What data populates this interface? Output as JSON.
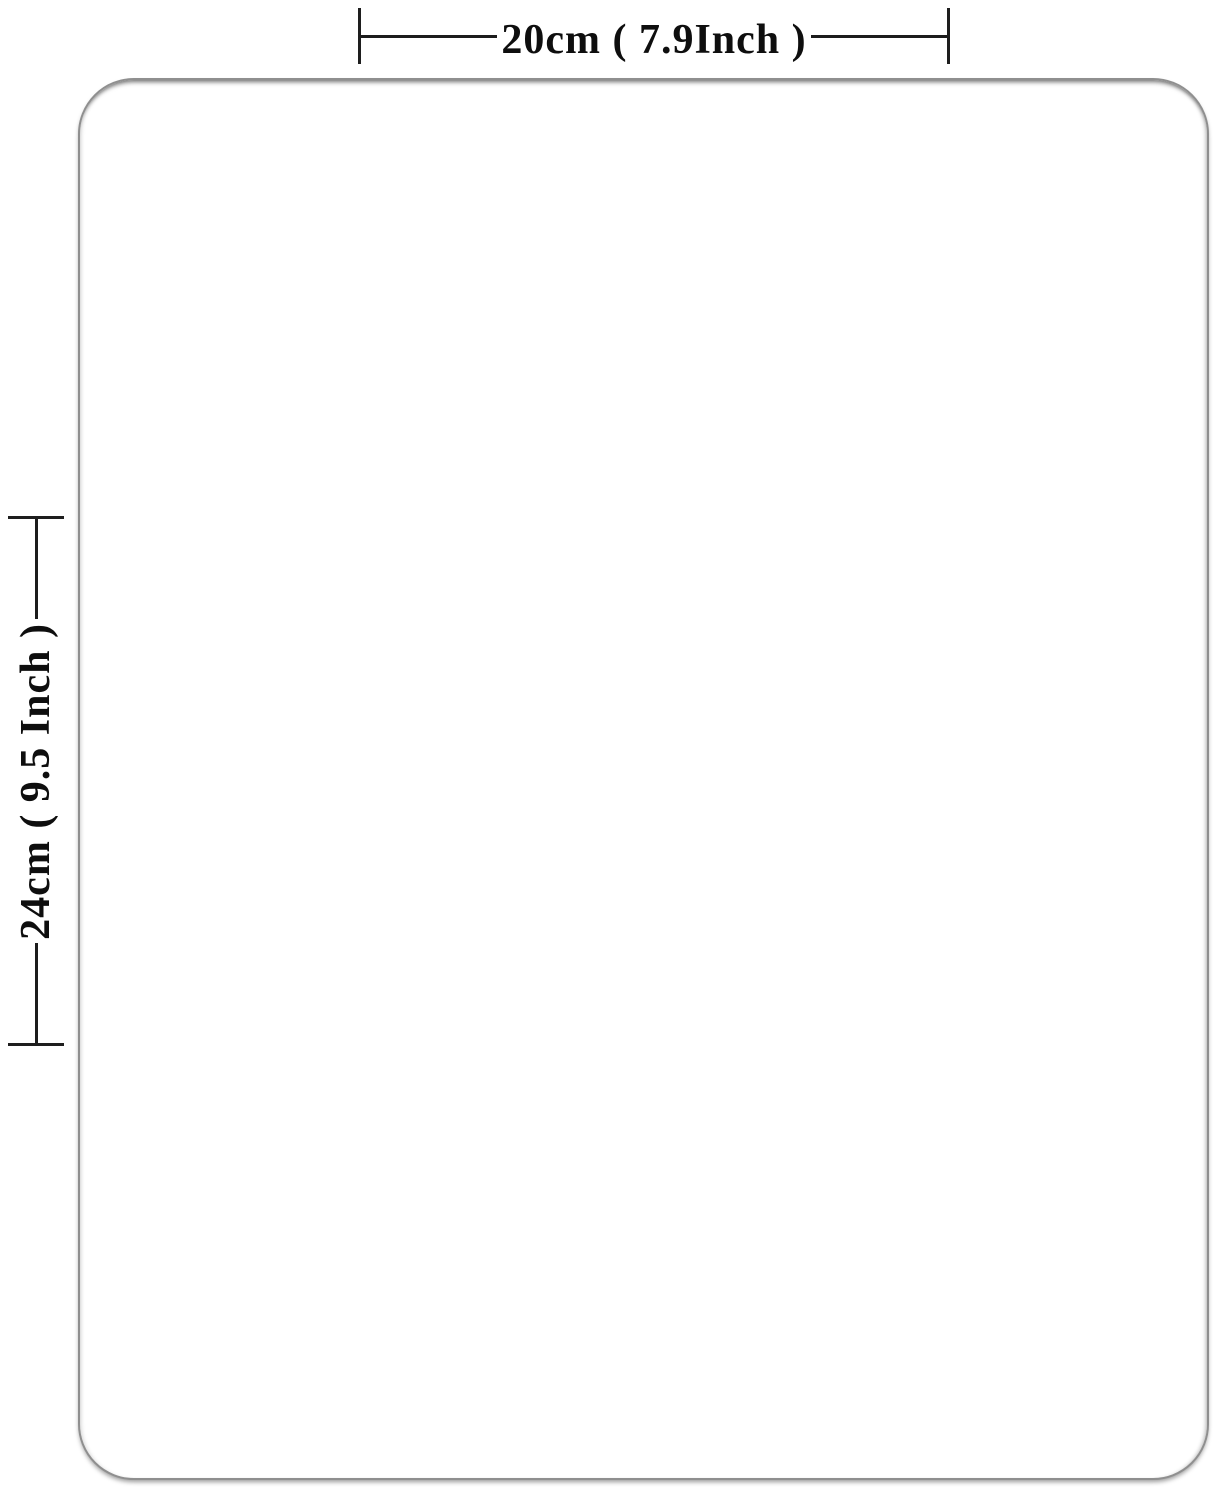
{
  "diagram": {
    "type": "product-dimension-diagram",
    "background_color": "#ffffff",
    "line_color": "#1c1c1c",
    "dimensions": {
      "width_label": "20cm ( 7.9Inch )",
      "height_label": "24cm ( 9.5 Inch )"
    },
    "product": {
      "shape": "rounded-rectangle",
      "fill_color": "#ffffff",
      "border_color": "#8f8f8f"
    }
  }
}
